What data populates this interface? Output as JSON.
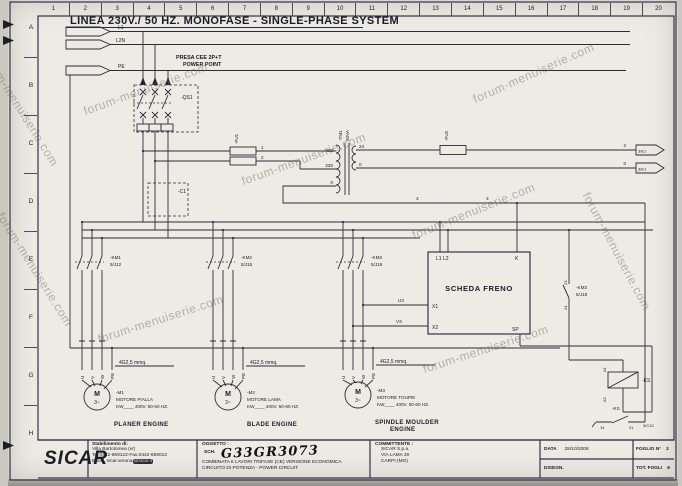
{
  "meta": {
    "watermark": "forum-menuiserie.com"
  },
  "ruler": {
    "columns": [
      "1",
      "2",
      "3",
      "4",
      "5",
      "6",
      "7",
      "8",
      "9",
      "10",
      "11",
      "12",
      "13",
      "14",
      "15",
      "16",
      "17",
      "18",
      "19",
      "20"
    ],
    "rows": [
      "A",
      "B",
      "C",
      "D",
      "E",
      "F",
      "G",
      "H"
    ]
  },
  "header": {
    "title": "LINEA 230V./ 50 HZ. MONOFASE - SINGLE-PHASE SYSTEM"
  },
  "buses": {
    "l1": "L1",
    "l2n": "L2N",
    "pe": "PE"
  },
  "power_point": {
    "line1": "PRESA CEE 2P+T",
    "line2": "POWER POINT"
  },
  "components": {
    "qs1": "-QS1",
    "c1": "-C1",
    "fu1": "-FU1",
    "fu2": "-FU2",
    "tm1_name": "-TM1",
    "tm1_rating": "50VA",
    "km3_aux_name": "-KM3",
    "km3_aux_ref": "5/J18",
    "ks_coil": "-KS",
    "ks_contact": "-KS",
    "ks_ref": "3/C10"
  },
  "transformer_taps": {
    "p400": "400",
    "p230": "230",
    "p0": "0",
    "s24": "24",
    "s0": "0"
  },
  "wires": {
    "w1": "1",
    "w2": "2",
    "w3": "3",
    "sec2": "2",
    "sec0": "0",
    "u3": "U3",
    "v3": "V3"
  },
  "connectors": {
    "ref1": "3/E1",
    "ref2": "3/E1"
  },
  "relay_terminals": {
    "a1": "A1",
    "a2": "A2",
    "t14": "14",
    "t21": "21",
    "t23": "23",
    "t24": "24"
  },
  "contactors": [
    {
      "name": "-KM1",
      "ref": "5/J12"
    },
    {
      "name": "-KM2",
      "ref": "5/J15"
    },
    {
      "name": "-KM3",
      "ref": "5/J18"
    }
  ],
  "brake_board": {
    "title": "SCHEDA FRENO",
    "l1l2": "L1 L2",
    "k": "K",
    "x1": "X1",
    "x2": "X2",
    "sp": "SP"
  },
  "cable_label": "4G2,5 mmq.",
  "motor_terminals": {
    "u": "U",
    "v": "V",
    "w": "W",
    "pe": "PE"
  },
  "motors": [
    {
      "name": "-M1",
      "desc": "MOTORE PIALLA",
      "rating": "KW____ 400V. 50-60 HZ.",
      "en": "PLANER ENGINE",
      "symbol": "M",
      "phase": "3~"
    },
    {
      "name": "-M2",
      "desc": "MOTORE LAMA",
      "rating": "KW____ 400V. 50-60 HZ.",
      "en": "BLADE ENGINE",
      "symbol": "M",
      "phase": "3~"
    },
    {
      "name": "-M3",
      "desc": "MOTORE TOUPIE",
      "rating": "KW____ 400V. 50-60 HZ.",
      "en1": "SPINDLE MOULDER",
      "en2": "ENGINE",
      "symbol": "M",
      "phase": "3~"
    }
  ],
  "title_block": {
    "logo": "SICAR",
    "factory_label": "Stabilimento di:",
    "factory_line1": "Villa Bartolomea (vr)",
    "factory_line2": "Tel.0442-659122-Fax.0442-659013",
    "email_pre": "Email. sicar.verona",
    "email_hl": "@sicar.it",
    "oggetto_label": "OGGETTO :",
    "sch_label": "SCH.",
    "handwritten": "G33GR3073",
    "oggetto_line1": "COMBINATA 6 LAVORI TRIFASE (CE) VERSIONE ECONOMICA",
    "oggetto_line2": "CIRCUITO DI POTENZA - POWER CIRCUIT",
    "committente_label": "COMMITTENTE :",
    "committente_line1": "SICAR S.p.a.",
    "committente_line2": "VIA LAMA 30",
    "committente_line3": "CARPI (MO)",
    "data_label": "DATA",
    "data_value": "28/10/2008",
    "foglio_label": "FOGLIO N°",
    "foglio_value": "2",
    "disegn_label": "DISEGN.",
    "tot_label": "TOT. FOGLI",
    "tot_value": "6"
  }
}
